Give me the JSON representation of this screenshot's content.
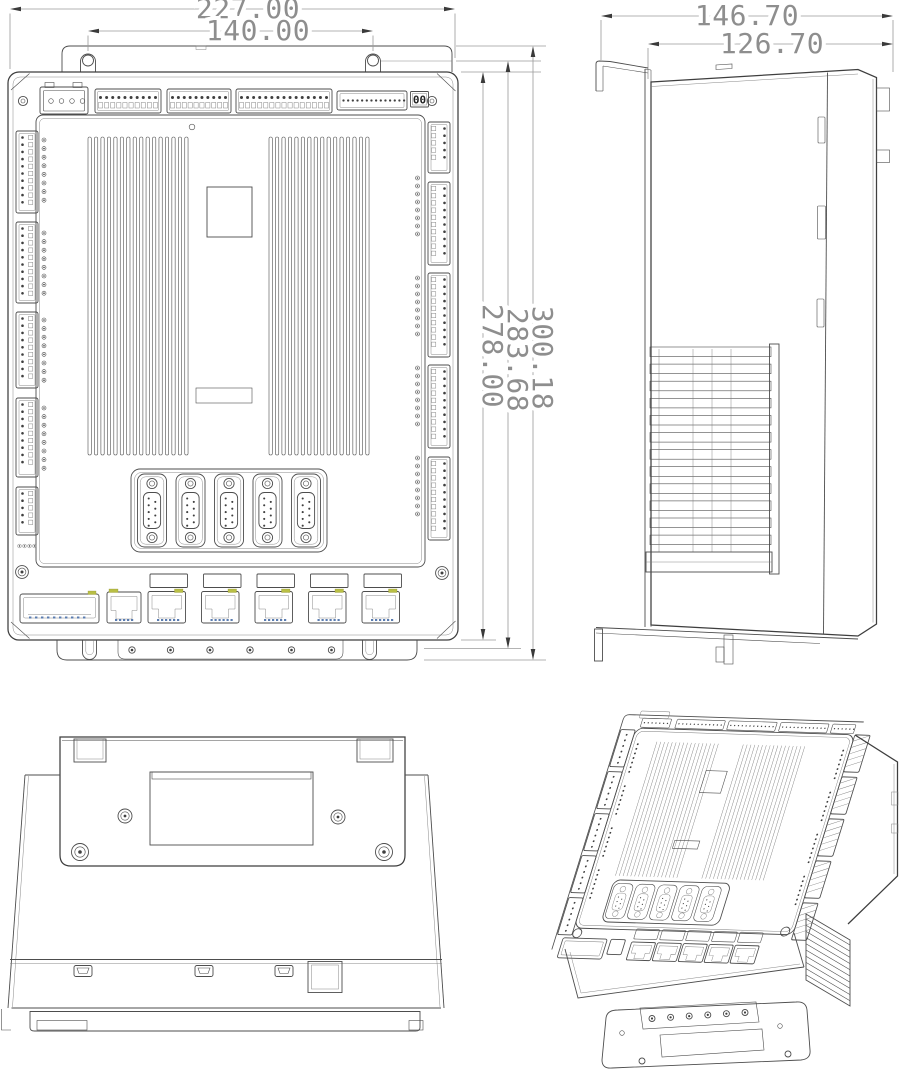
{
  "front_view": {
    "dim_overall_width": "227.00",
    "dim_mount_hole_spacing": "140.00",
    "dim_body_height": "278.00",
    "dim_mount_plate_height": "283.68",
    "dim_overall_height": "300.18",
    "address_display": "00"
  },
  "side_view": {
    "dim_overall_depth": "146.70",
    "dim_body_depth": "126.70"
  },
  "colors": {
    "line": "#4d4d4d",
    "dim_text": "#8e8e8e",
    "led_yellow": "#b9bf45",
    "pin_blue": "#5a7cb0"
  }
}
